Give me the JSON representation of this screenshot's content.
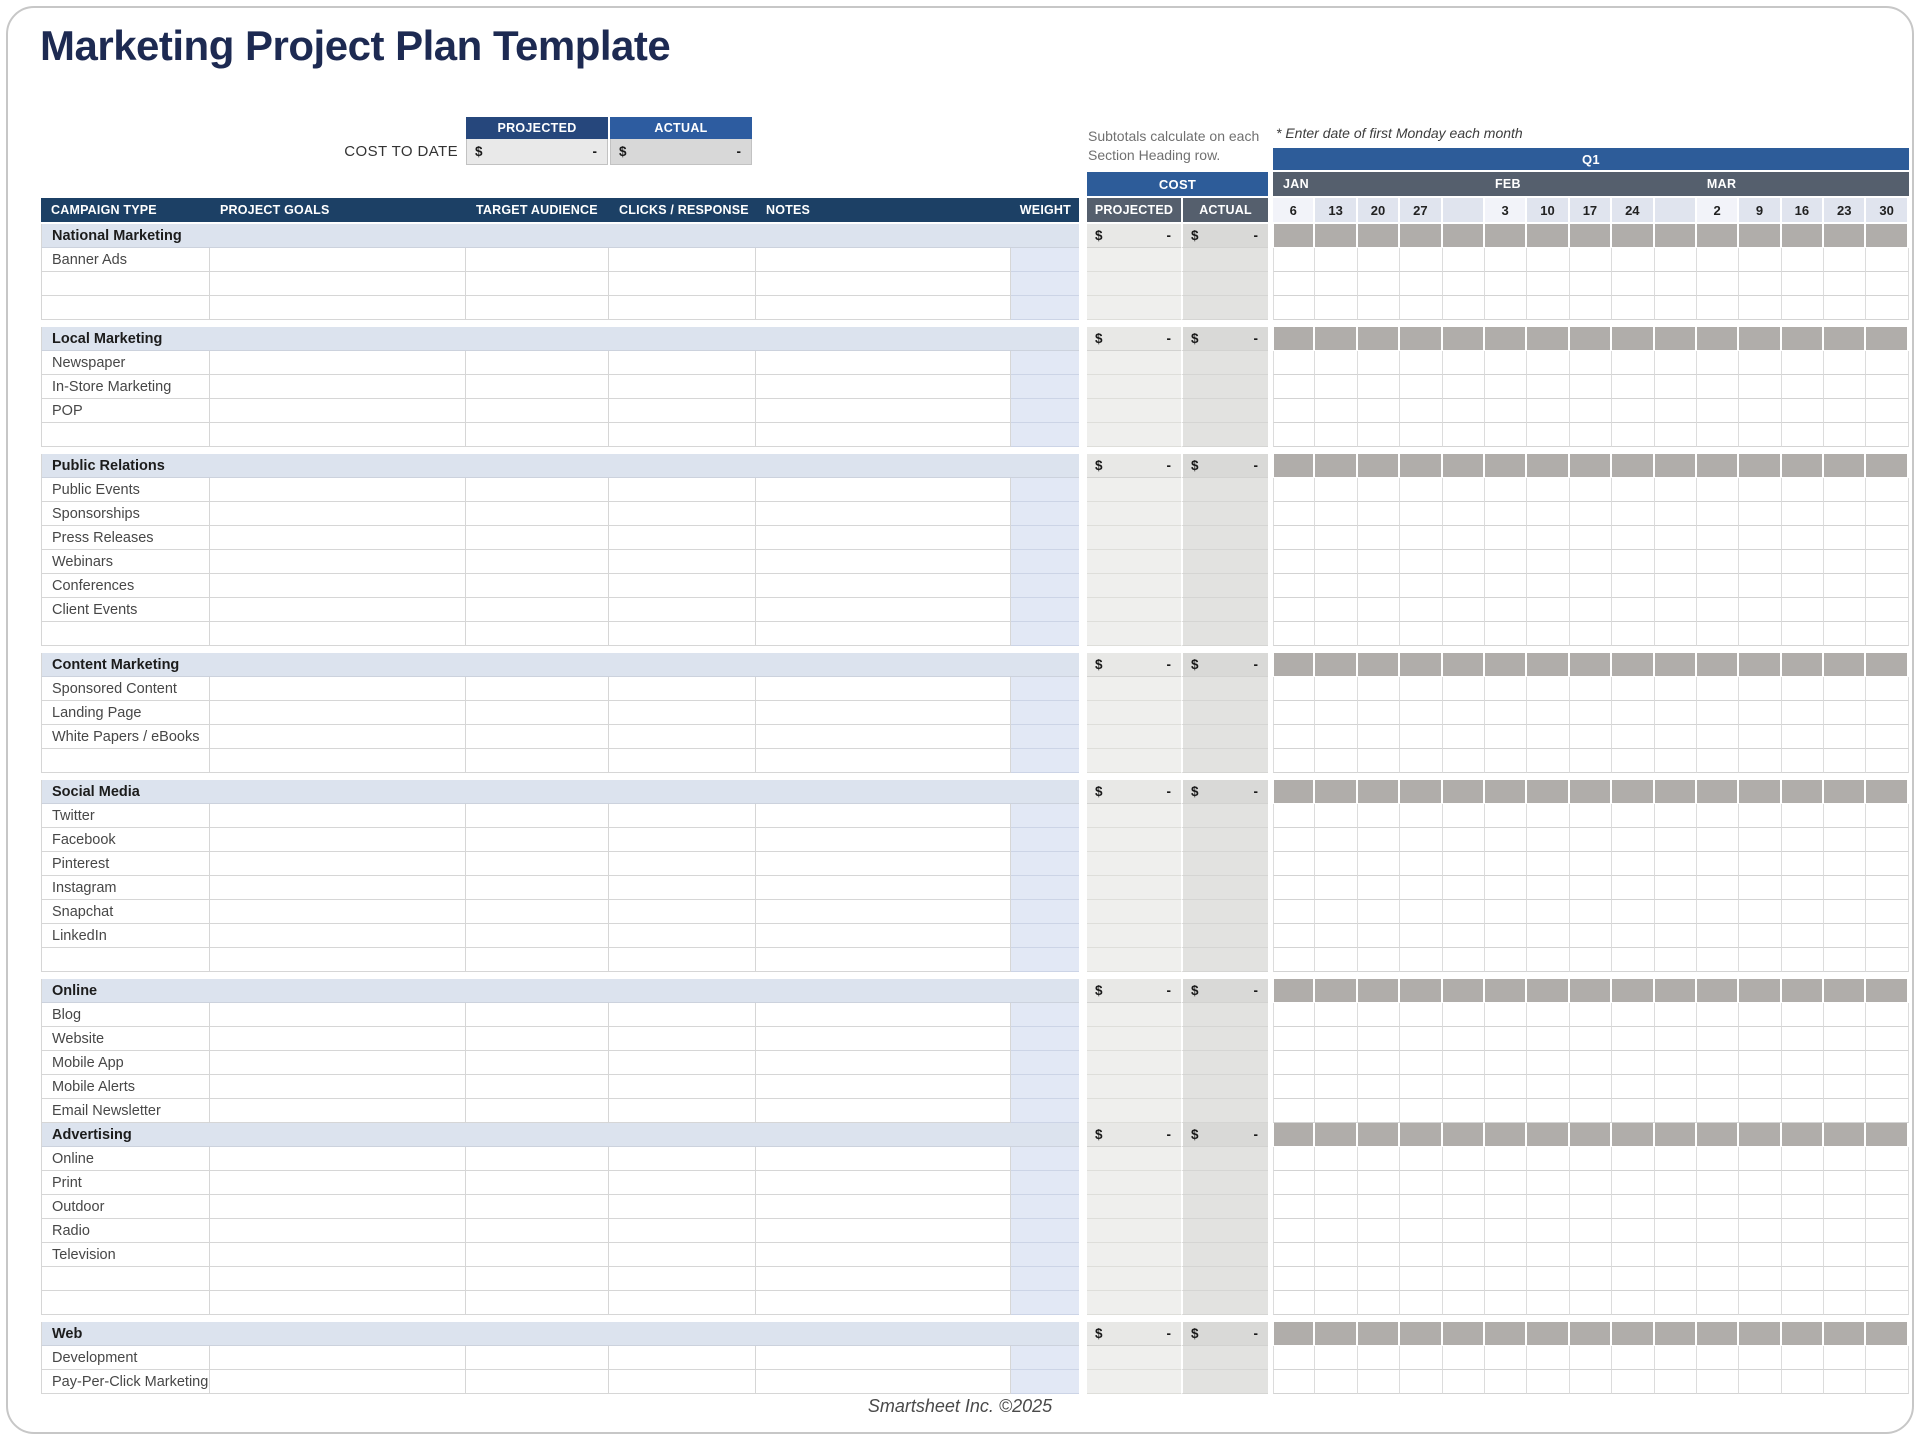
{
  "page": {
    "title": "Marketing Project Plan Template",
    "footer": "Smartsheet Inc. ©2025"
  },
  "cost_to_date": {
    "label": "COST TO DATE",
    "columns": [
      {
        "label": "PROJECTED",
        "currency": "$",
        "value": "-"
      },
      {
        "label": "ACTUAL",
        "currency": "$",
        "value": "-"
      }
    ]
  },
  "annotations": {
    "subtotals_note": "Subtotals calculate on each Section Heading row.",
    "monday_note": "* Enter date of first Monday each month"
  },
  "timeline": {
    "quarter_label": "Q1",
    "months": [
      {
        "label": "JAN",
        "dates": [
          "6",
          "13",
          "20",
          "27",
          ""
        ]
      },
      {
        "label": "FEB",
        "dates": [
          "3",
          "10",
          "17",
          "24",
          ""
        ]
      },
      {
        "label": "MAR",
        "dates": [
          "2",
          "9",
          "16",
          "23",
          "30"
        ]
      }
    ]
  },
  "table": {
    "headers": {
      "campaign_type": "CAMPAIGN TYPE",
      "project_goals": "PROJECT GOALS",
      "target_audience": "TARGET AUDIENCE",
      "clicks_response": "CLICKS / RESPONSE",
      "notes": "NOTES",
      "weight": "WEIGHT",
      "cost": "COST",
      "projected": "PROJECTED",
      "actual": "ACTUAL"
    },
    "subtotal_currency": "$",
    "subtotal_value": "-",
    "sections": [
      {
        "name": "National Marketing",
        "items": [
          "Banner Ads",
          "",
          ""
        ],
        "gap_after": true
      },
      {
        "name": "Local Marketing",
        "items": [
          "Newspaper",
          "In-Store Marketing",
          "POP",
          ""
        ],
        "gap_after": true
      },
      {
        "name": "Public Relations",
        "items": [
          "Public Events",
          "Sponsorships",
          "Press Releases",
          "Webinars",
          "Conferences",
          "Client Events",
          ""
        ],
        "gap_after": true
      },
      {
        "name": "Content Marketing",
        "items": [
          "Sponsored Content",
          "Landing Page",
          "White Papers / eBooks",
          ""
        ],
        "gap_after": true
      },
      {
        "name": "Social Media",
        "items": [
          "Twitter",
          "Facebook",
          "Pinterest",
          "Instagram",
          "Snapchat",
          "LinkedIn",
          ""
        ],
        "gap_after": true
      },
      {
        "name": "Online",
        "items": [
          "Blog",
          "Website",
          "Mobile App",
          "Mobile Alerts",
          "Email Newsletter"
        ],
        "gap_after": false
      },
      {
        "name": "Advertising",
        "items": [
          "Online",
          "Print",
          "Outdoor",
          "Radio",
          "Television",
          "",
          ""
        ],
        "gap_after": true
      },
      {
        "name": "Web",
        "items": [
          "Development",
          "Pay-Per-Click Marketing"
        ],
        "gap_after": false
      }
    ]
  },
  "colors": {
    "title_navy": "#1d2a52",
    "header_navy": "#1c4065",
    "timeline_blue": "#2d5c99",
    "slate": "#555f6d",
    "section_bg": "#dce3ee",
    "section_date_gray": "#b0adaa",
    "weight_band": "#e2e8f5",
    "projected_band": "#efefed",
    "actual_band": "#e2e2e0",
    "date_head": "#e0e4ee",
    "date_head_first": "#f2f3f9",
    "cost_projected_header": "#26477c",
    "cost_actual_header": "#2d5ca0"
  }
}
